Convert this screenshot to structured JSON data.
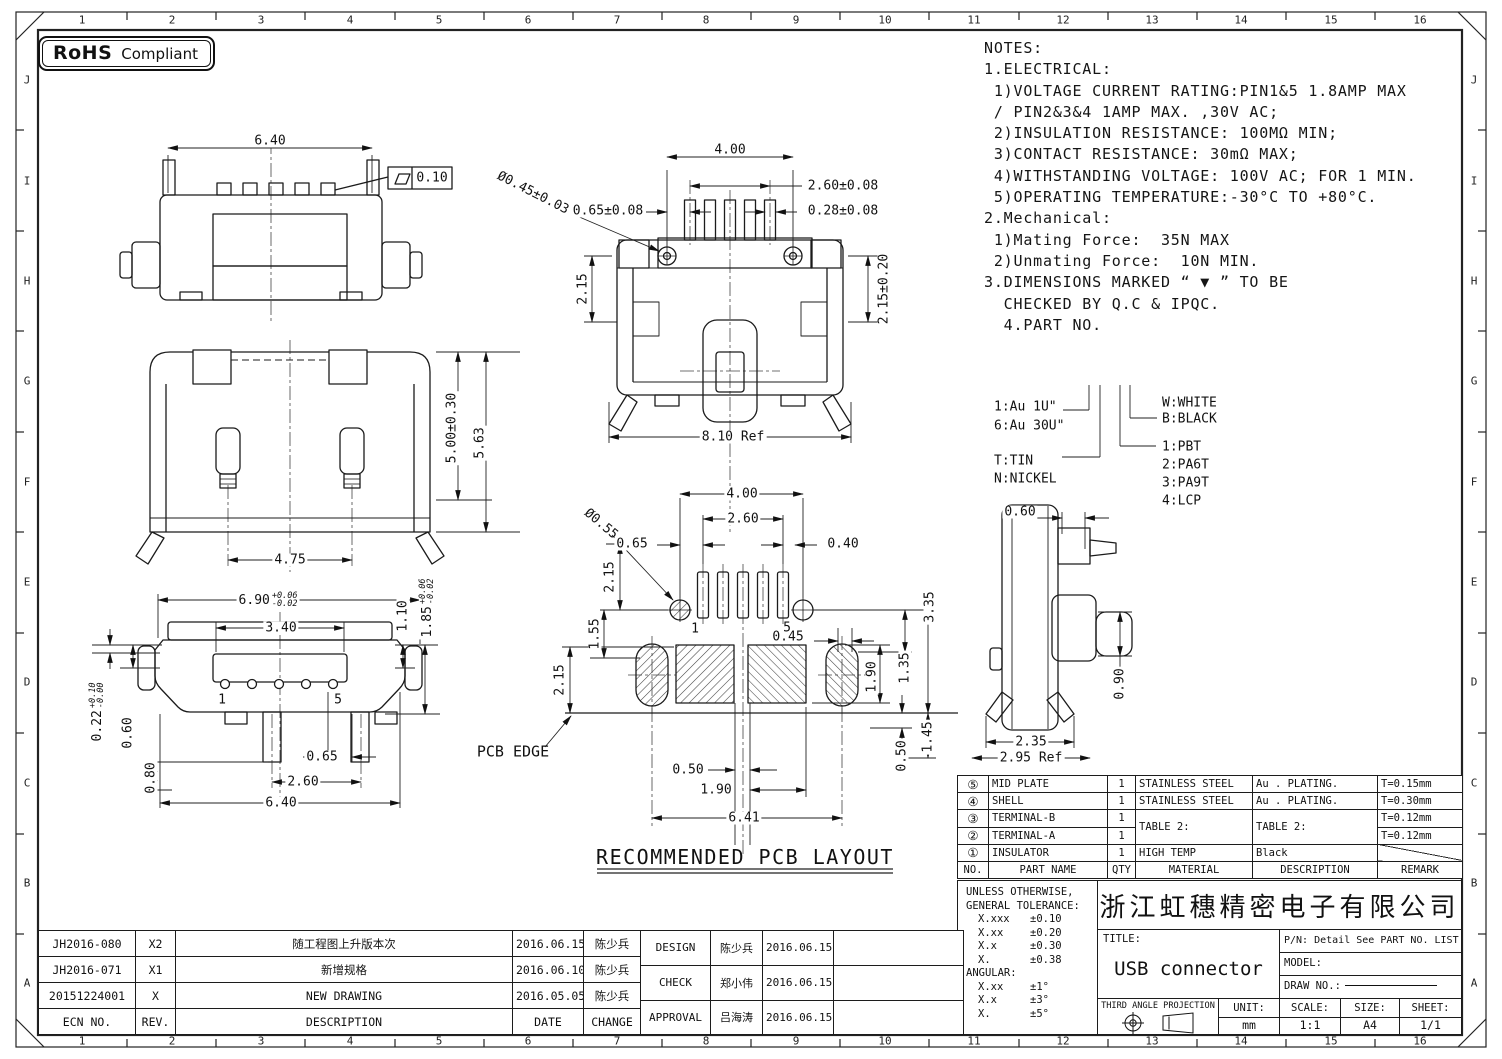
{
  "badge": {
    "bold": "RoHS",
    "rest": "Compliant"
  },
  "zones": {
    "cols": [
      "1",
      "2",
      "3",
      "4",
      "5",
      "6",
      "7",
      "8",
      "9",
      "10",
      "11",
      "12",
      "13",
      "14",
      "15",
      "16"
    ],
    "rows": [
      "J",
      "I",
      "H",
      "G",
      "F",
      "E",
      "D",
      "C",
      "B",
      "A"
    ]
  },
  "notes": {
    "lines": [
      "NOTES:",
      "1.ELECTRICAL:",
      " 1)VOLTAGE CURRENT RATING:PIN1&5 1.8AMP MAX",
      " / PIN2&3&4 1AMP MAX. ,30V AC;",
      " 2)INSULATION RESISTANCE: 100MΩ MIN;",
      " 3)CONTACT RESISTANCE: 30mΩ MAX;",
      " 4)WITHSTANDING VOLTAGE: 100V AC; FOR 1 MIN.",
      " 5)OPERATING TEMPERATURE:-30°C TO +80°C.",
      "2.Mechanical:",
      " 1)Mating Force:  35N MAX",
      " 2)Unmating Force:  10N MIN.",
      "3.DIMENSIONS MARKED “ ▼ ” TO BE",
      "  CHECKED BY Q.C & IPQC.",
      "",
      "  4.PART NO."
    ]
  },
  "part_no_tree": {
    "plating1": "1:Au 1U\"",
    "plating2": "6:Au 30U\"",
    "term1": "T:TIN",
    "term2": "N:NICKEL",
    "color1": "W:WHITE",
    "color2": "B:BLACK",
    "mat1": "1:PBT",
    "mat2": "2:PA6T",
    "mat3": "3:PA9T",
    "mat4": "4:LCP"
  },
  "dims": {
    "top": {
      "w": "6.40",
      "flat": "0.10"
    },
    "plan": {
      "d400": "4.00",
      "d260": "2.60±0.08",
      "d065": "0.65±0.08",
      "d028": "0.28±0.08",
      "hole": "Ø0.45±0.03",
      "d215l": "2.15",
      "d215r": "2.15±0.20",
      "ref": "8.10 Ref"
    },
    "rear": {
      "d500": "5.00±0.30",
      "d563": "5.63",
      "d475": "4.75"
    },
    "front": {
      "d690": "6.90",
      "d690t": "+0.06",
      "d690b": "-0.02",
      "d340": "3.40",
      "d110": "1.10",
      "d185": "1.85",
      "d185t": "+0.06",
      "d185b": "-0.02",
      "d022": "0.22",
      "d022t": "+0.10",
      "d022b": "-0.00",
      "d060": "0.60",
      "d080": "0.80",
      "d065": "0.65",
      "d260": "2.60",
      "d640": "6.40",
      "pin1": "1",
      "pin5": "5"
    },
    "pcb": {
      "hole": "Ø0.55",
      "d400": "4.00",
      "d260": "2.60",
      "d065": "0.65",
      "d040": "0.40",
      "d215a": "2.15",
      "d155": "1.55",
      "d215b": "2.15",
      "d045": "0.45",
      "d135": "1.35",
      "d335": "3.35",
      "d190v": "1.90",
      "d145": "1.45",
      "d050r": "0.50",
      "d050b": "0.50",
      "d190b": "1.90",
      "d641": "6.41",
      "pin1": "1",
      "pin5": "5",
      "edge": "PCB EDGE",
      "caption": "RECOMMENDED PCB LAYOUT"
    },
    "side": {
      "d060": "0.60",
      "d090": "0.90",
      "d235": "2.35",
      "ref": "2.95 Ref"
    }
  },
  "bom": {
    "headers": [
      "NO.",
      "PART NAME",
      "QTY",
      "MATERIAL",
      "DESCRIPTION",
      "REMARK"
    ],
    "rows": [
      {
        "no": "⑤",
        "name": "MID PLATE",
        "qty": "1",
        "material": "STAINLESS STEEL",
        "desc": "Au . PLATING.",
        "remark": "T=0.15mm"
      },
      {
        "no": "④",
        "name": "SHELL",
        "qty": "1",
        "material": "STAINLESS STEEL",
        "desc": "Au . PLATING.",
        "remark": "T=0.30mm"
      },
      {
        "no": "③",
        "name": "TERMINAL-B",
        "qty": "1",
        "material": "TABLE 2:",
        "desc": "TABLE 2:",
        "remark": "T=0.12mm"
      },
      {
        "no": "②",
        "name": "TERMINAL-A",
        "qty": "1",
        "remark": "T=0.12mm"
      },
      {
        "no": "①",
        "name": "INSULATOR",
        "qty": "1",
        "material": "HIGH TEMP",
        "desc": "Black",
        "remark": ""
      }
    ]
  },
  "tolerance": {
    "title1": "UNLESS OTHERWISE,",
    "title2": "GENERAL TOLERANCE:",
    "rows": [
      [
        "X.xxx",
        "±0.10"
      ],
      [
        "X.xx",
        "±0.20"
      ],
      [
        "X.x",
        "±0.30"
      ],
      [
        "X.",
        "±0.38"
      ]
    ],
    "angular": "ANGULAR:",
    "angular_rows": [
      [
        "X.xx",
        "±1°"
      ],
      [
        "X.x",
        "±3°"
      ],
      [
        "X.",
        "±5°"
      ]
    ]
  },
  "title_block": {
    "company": "浙江虹穗精密电子有限公司",
    "title_label": "TITLE:",
    "title_value": "USB connector",
    "pn": "P/N: Detail See PART NO. LIST",
    "model_label": "MODEL:",
    "draw_label": "DRAW NO.:",
    "projection": "THIRD ANGLE PROJECTION",
    "unit_label": "UNIT:",
    "unit_value": "mm",
    "scale_label": "SCALE:",
    "scale_value": "1:1",
    "size_label": "SIZE:",
    "size_value": "A4",
    "sheet_label": "SHEET:",
    "sheet_value": "1/1"
  },
  "revisions": {
    "headers": [
      "ECN NO.",
      "REV.",
      "DESCRIPTION",
      "DATE",
      "CHANGE"
    ],
    "rows": [
      [
        "JH2016-080",
        "X2",
        "随工程图上升版本次",
        "2016.06.15",
        "陈少兵"
      ],
      [
        "JH2016-071",
        "X1",
        "新增规格",
        "2016.06.10",
        "陈少兵"
      ],
      [
        "20151224001",
        "X",
        "NEW DRAWING",
        "2016.05.05",
        "陈少兵"
      ]
    ]
  },
  "approvals": {
    "rows": [
      [
        "DESIGN",
        "陈少兵",
        "2016.06.15"
      ],
      [
        "CHECK",
        "郑小伟",
        "2016.06.15"
      ],
      [
        "APPROVAL",
        "吕海涛",
        "2016.06.15"
      ]
    ]
  }
}
